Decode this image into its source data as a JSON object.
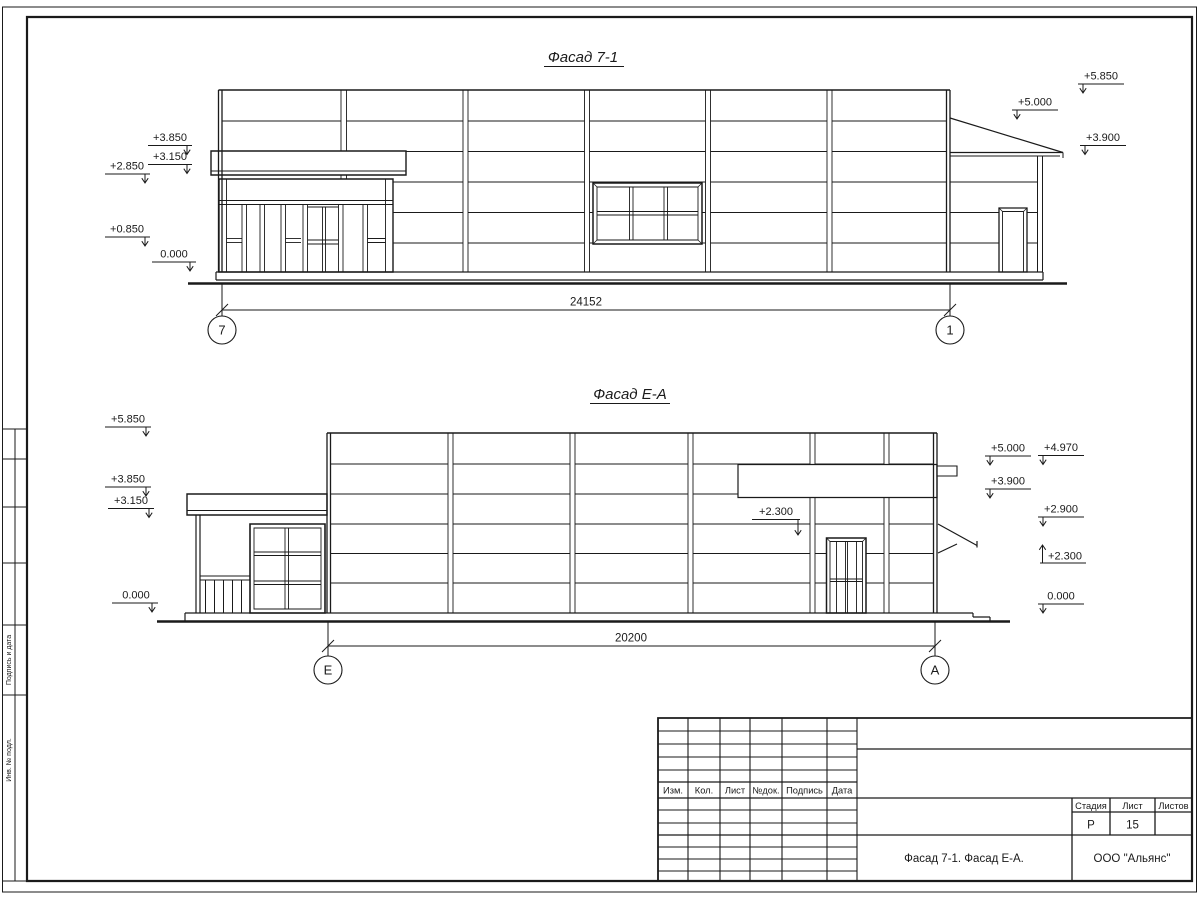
{
  "drawing": {
    "f1": {
      "title": "Фасад 7-1",
      "dim": "24152",
      "axis_left": "7",
      "axis_right": "1",
      "marks_left": [
        "+3.850",
        "+3.150",
        "+2.850",
        "+0.850",
        "0.000"
      ],
      "marks_right": [
        "+5.850",
        "+5.000",
        "+3.900"
      ]
    },
    "f2": {
      "title": "Фасад Е-А",
      "dim": "20200",
      "axis_left": "Е",
      "axis_right": "А",
      "marks_left": [
        "+5.850",
        "+3.850",
        "+3.150",
        "0.000"
      ],
      "leader_mark": "+2.300",
      "marks_right": [
        "+5.000",
        "+3.900"
      ],
      "marks_far_right": [
        "+4.970",
        "+2.900",
        "+2.300",
        "0.000"
      ]
    }
  },
  "title_block": {
    "rev_cols": [
      "Изм.",
      "Кол.",
      "Лист",
      "№док.",
      "Подпись",
      "Дата"
    ],
    "stage_label": "Стадия",
    "sheet_label": "Лист",
    "sheets_label": "Листов",
    "stage": "Р",
    "sheet": "15",
    "doc_name": "Фасад 7-1. Фасад Е-А.",
    "company": "ООО \"Альянс\""
  },
  "side_stamp": {
    "sign_date": "Подпись и дата",
    "inv_no": "Инв. № подл."
  }
}
